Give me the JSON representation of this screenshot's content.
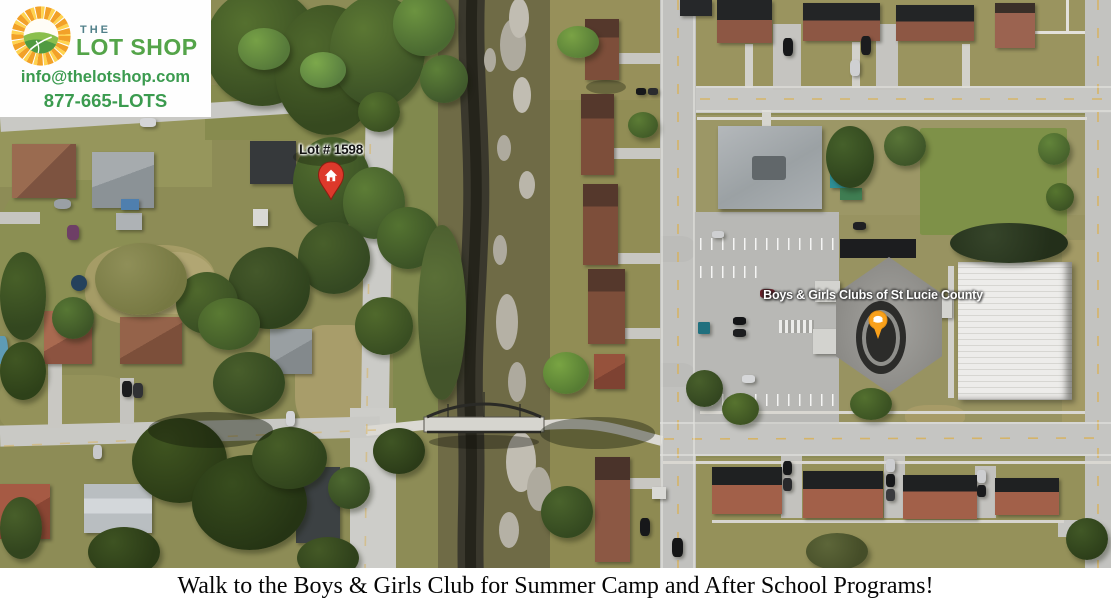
{
  "logo": {
    "brand_prefix": "THE",
    "brand_name": "LOT SHOP",
    "email": "info@thelotshop.com",
    "phone": "877-665-LOTS",
    "colors": {
      "brand_green": "#54a449",
      "brand_teal": "#51808a",
      "contact_green": "#3b9b4f",
      "sun_orange": "#f2a128",
      "sun_yellow": "#ffd34f",
      "hill_green": "#4f9a41"
    }
  },
  "map": {
    "lot_marker": {
      "label": "Lot # 1598",
      "pin_color": "#dd392b",
      "pin_glyph": "home-icon"
    },
    "club_marker": {
      "label": "Boys & Girls Clubs of St Lucie County",
      "pin_color": "#f9a11b",
      "pin_glyph": "place-icon"
    }
  },
  "caption": {
    "text": "Walk to the Boys & Girls Club for Summer Camp and After School Programs!"
  }
}
